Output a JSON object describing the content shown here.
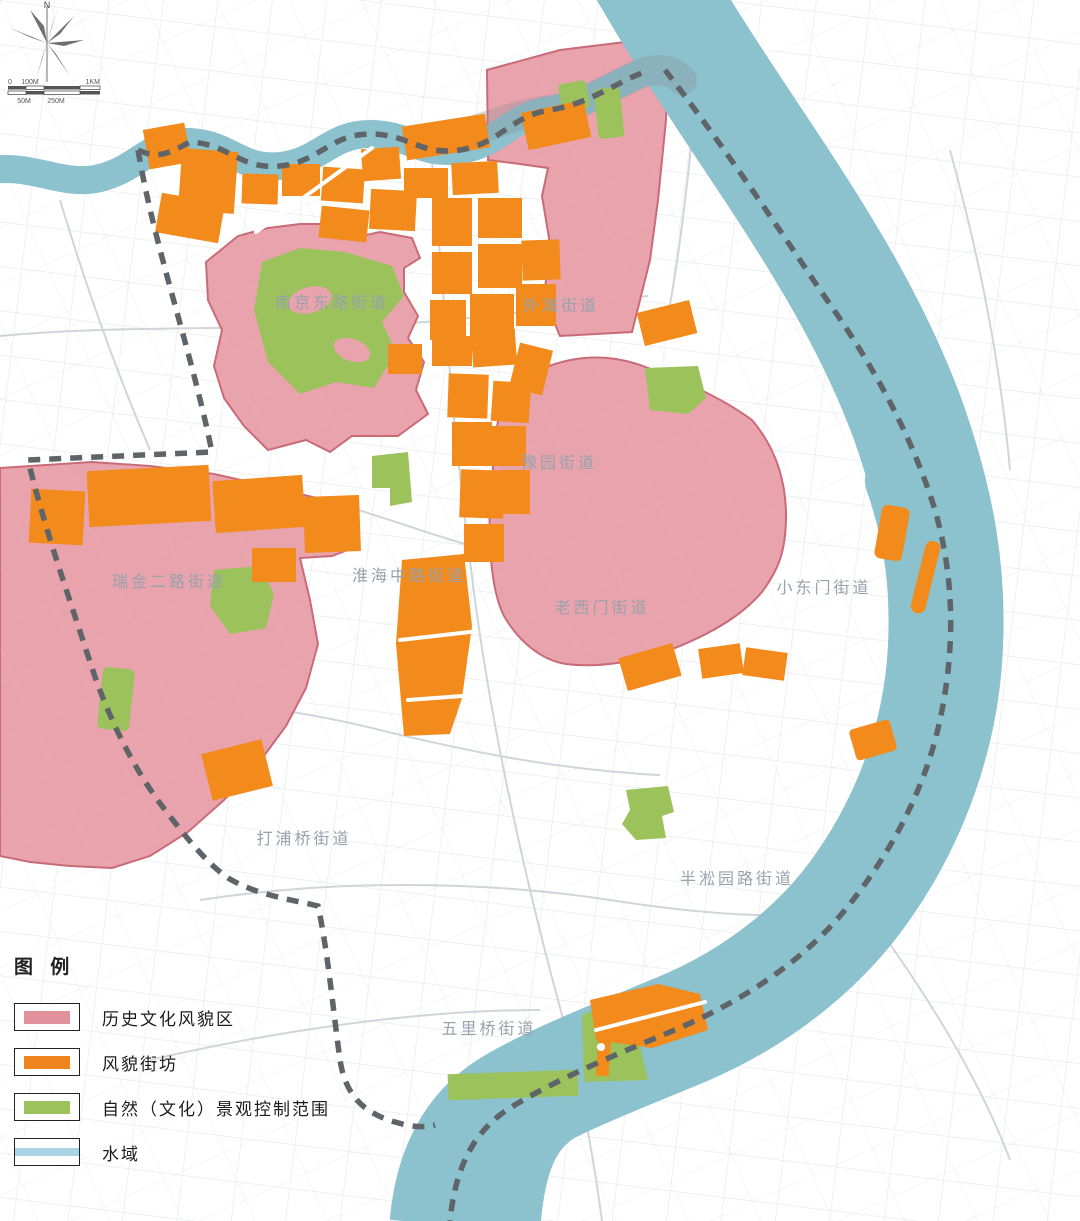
{
  "compass": {
    "north_label": "N"
  },
  "scale_bar": {
    "top_labels": [
      "0",
      "100M",
      "1KM"
    ],
    "bottom_labels": [
      "50M",
      "250M"
    ]
  },
  "map": {
    "district_labels": [
      {
        "id": "nanjing-east-road",
        "text": "南京东路街道"
      },
      {
        "id": "bund",
        "text": "外滩街道"
      },
      {
        "id": "yuyuan",
        "text": "豫园街道"
      },
      {
        "id": "ruijin-2nd-road",
        "text": "瑞金二路街道"
      },
      {
        "id": "huaihai-mid-road",
        "text": "淮海中路街道"
      },
      {
        "id": "laoximen",
        "text": "老西门街道"
      },
      {
        "id": "xiaodongmen",
        "text": "小东门街道"
      },
      {
        "id": "dapuqiao",
        "text": "打浦桥街道"
      },
      {
        "id": "bansongyuan-road",
        "text": "半淞园路街道"
      },
      {
        "id": "wuliqiao",
        "text": "五里桥街道"
      }
    ]
  },
  "legend": {
    "title": "图 例",
    "items": [
      {
        "id": "historic-area",
        "label": "历史文化风貌区",
        "color": "#e2909b"
      },
      {
        "id": "scenic-block",
        "label": "风貌街坊",
        "color": "#f0841c"
      },
      {
        "id": "landscape-control",
        "label": "自然（文化）景观控制范围",
        "color": "#9cc25c"
      },
      {
        "id": "water-area",
        "label": "水域",
        "color": "#a9d3e2"
      }
    ]
  },
  "colors": {
    "historic_area_fill": "#e9a3ad",
    "historic_area_border": "#c96b77",
    "scenic_block_fill": "#f28a1c",
    "landscape_control_fill": "#9cc25c",
    "water_fill": "#8cc1ce",
    "boundary_dash": "#5f6468",
    "road_line": "#d8dbde",
    "label_text": "#98a1ac"
  }
}
